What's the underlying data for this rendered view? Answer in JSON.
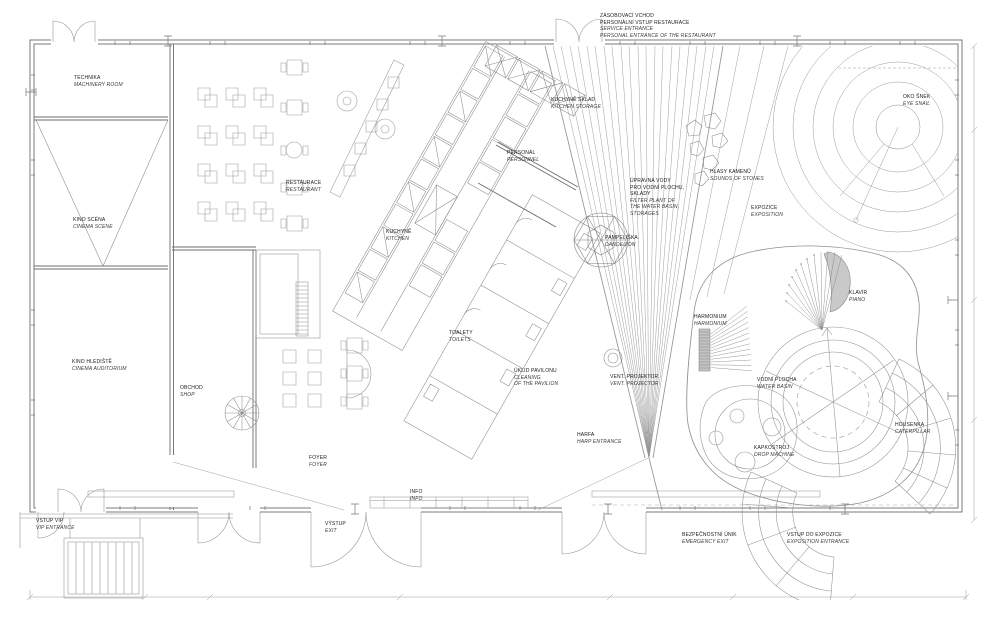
{
  "document": {
    "kind_note": "architectural ground floor plan, monochrome line drawing"
  },
  "colors": {
    "background": "#ffffff",
    "wall_line": "#6d6d6d",
    "thin_line": "#949494",
    "furniture_line": "#9a9a9a",
    "piano_fill": "#c9c9c9",
    "text": "#1a1a1a"
  },
  "labels": {
    "service": {
      "cz": [
        "ZÁSOBOVACÍ VCHOD",
        "PERSONÁLNÍ VSTUP RESTAURACE"
      ],
      "en": [
        "SERVICE ENTRANCE",
        "PERSONAL ENTRANCE OF THE RESTAURANT"
      ]
    },
    "technika": {
      "cz": [
        "TECHNIKA"
      ],
      "en": [
        "MACHINERY ROOM"
      ]
    },
    "oko_snek": {
      "cz": [
        "OKO ŠNEK"
      ],
      "en": [
        "EYE SNAIL"
      ]
    },
    "kuchyne_sklad": {
      "cz": [
        "KUCHYNĚ SKLAD"
      ],
      "en": [
        "KITCHEN STORAGE"
      ]
    },
    "personal": {
      "cz": [
        "PERSONÁL"
      ],
      "en": [
        "PERSONNEL"
      ]
    },
    "kino_scena": {
      "cz": [
        "KINO SCÉNA"
      ],
      "en": [
        "CINEMA SCENE"
      ]
    },
    "restaurace": {
      "cz": [
        "RESTAURACE"
      ],
      "en": [
        "RESTAURANT"
      ]
    },
    "hlasy_kamenu": {
      "cz": [
        "HLASY KAMENŮ"
      ],
      "en": [
        "SOUNDS OF STONES"
      ]
    },
    "upravna": {
      "cz": [
        "ÚPRAVNA VODY",
        "PRO VODNÍ PLOCHU,",
        "SKLADY"
      ],
      "en": [
        "FILTER PLANT OF",
        "THE WATER BASIN,",
        "STORAGES"
      ]
    },
    "expozice": {
      "cz": [
        "EXPOZICE"
      ],
      "en": [
        "EXPOSITION"
      ]
    },
    "pampeliska": {
      "cz": [
        "PAMPELIŠKA"
      ],
      "en": [
        "DANDELION"
      ]
    },
    "kuchyne": {
      "cz": [
        "KUCHYNĚ"
      ],
      "en": [
        "KITCHEN"
      ]
    },
    "klavir": {
      "cz": [
        "KLAVÍR"
      ],
      "en": [
        "PIANO"
      ]
    },
    "harmonium": {
      "cz": [
        "HARMONIUM"
      ],
      "en": [
        "HARMONIUM"
      ]
    },
    "kino_hlediste": {
      "cz": [
        "KINO HLEDIŠTĚ"
      ],
      "en": [
        "CINEMA AUDITORIUM"
      ]
    },
    "toalety": {
      "cz": [
        "TOALETY"
      ],
      "en": [
        "TOILETS"
      ]
    },
    "uklid": {
      "cz": [
        "ÚKLID PAVILONU"
      ],
      "en": [
        "CLEANING",
        "OF THE PAVILION"
      ]
    },
    "vent_projektor": {
      "cz": [
        "VENT. PROJEKTOR"
      ],
      "en": [
        "VENT. PROJECTOR"
      ]
    },
    "obchod": {
      "cz": [
        "OBCHOD"
      ],
      "en": [
        "SHOP"
      ]
    },
    "vodni_plocha": {
      "cz": [
        "VODNÍ PLOCHA"
      ],
      "en": [
        "WATER BASIN"
      ]
    },
    "kapkostroj": {
      "cz": [
        "KAPKOSTROJ"
      ],
      "en": [
        "DROP MACHINE"
      ]
    },
    "housenka": {
      "cz": [
        "HOUSENKA"
      ],
      "en": [
        "CATERPILLAR"
      ]
    },
    "harfa": {
      "cz": [
        "HARFA"
      ],
      "en": [
        "HARP ENTRANCE"
      ]
    },
    "foyer": {
      "cz": [
        "FOYER"
      ],
      "en": [
        "FOYER"
      ]
    },
    "info": {
      "cz": [
        "INFO"
      ],
      "en": [
        "INFO"
      ]
    },
    "vystup": {
      "cz": [
        "VÝSTUP"
      ],
      "en": [
        "EXIT"
      ]
    },
    "vstup_vip": {
      "cz": [
        "VSTUP VIP"
      ],
      "en": [
        "VIP ENTRANCE"
      ]
    },
    "bezpecnostni": {
      "cz": [
        "BEZPEČNOSTNÍ ÚNIK"
      ],
      "en": [
        "EMERGENCY EXIT"
      ]
    },
    "vstup_expozice": {
      "cz": [
        "VSTUP DO EXPOZICE"
      ],
      "en": [
        "EXPOSITION ENTRANCE"
      ]
    }
  }
}
